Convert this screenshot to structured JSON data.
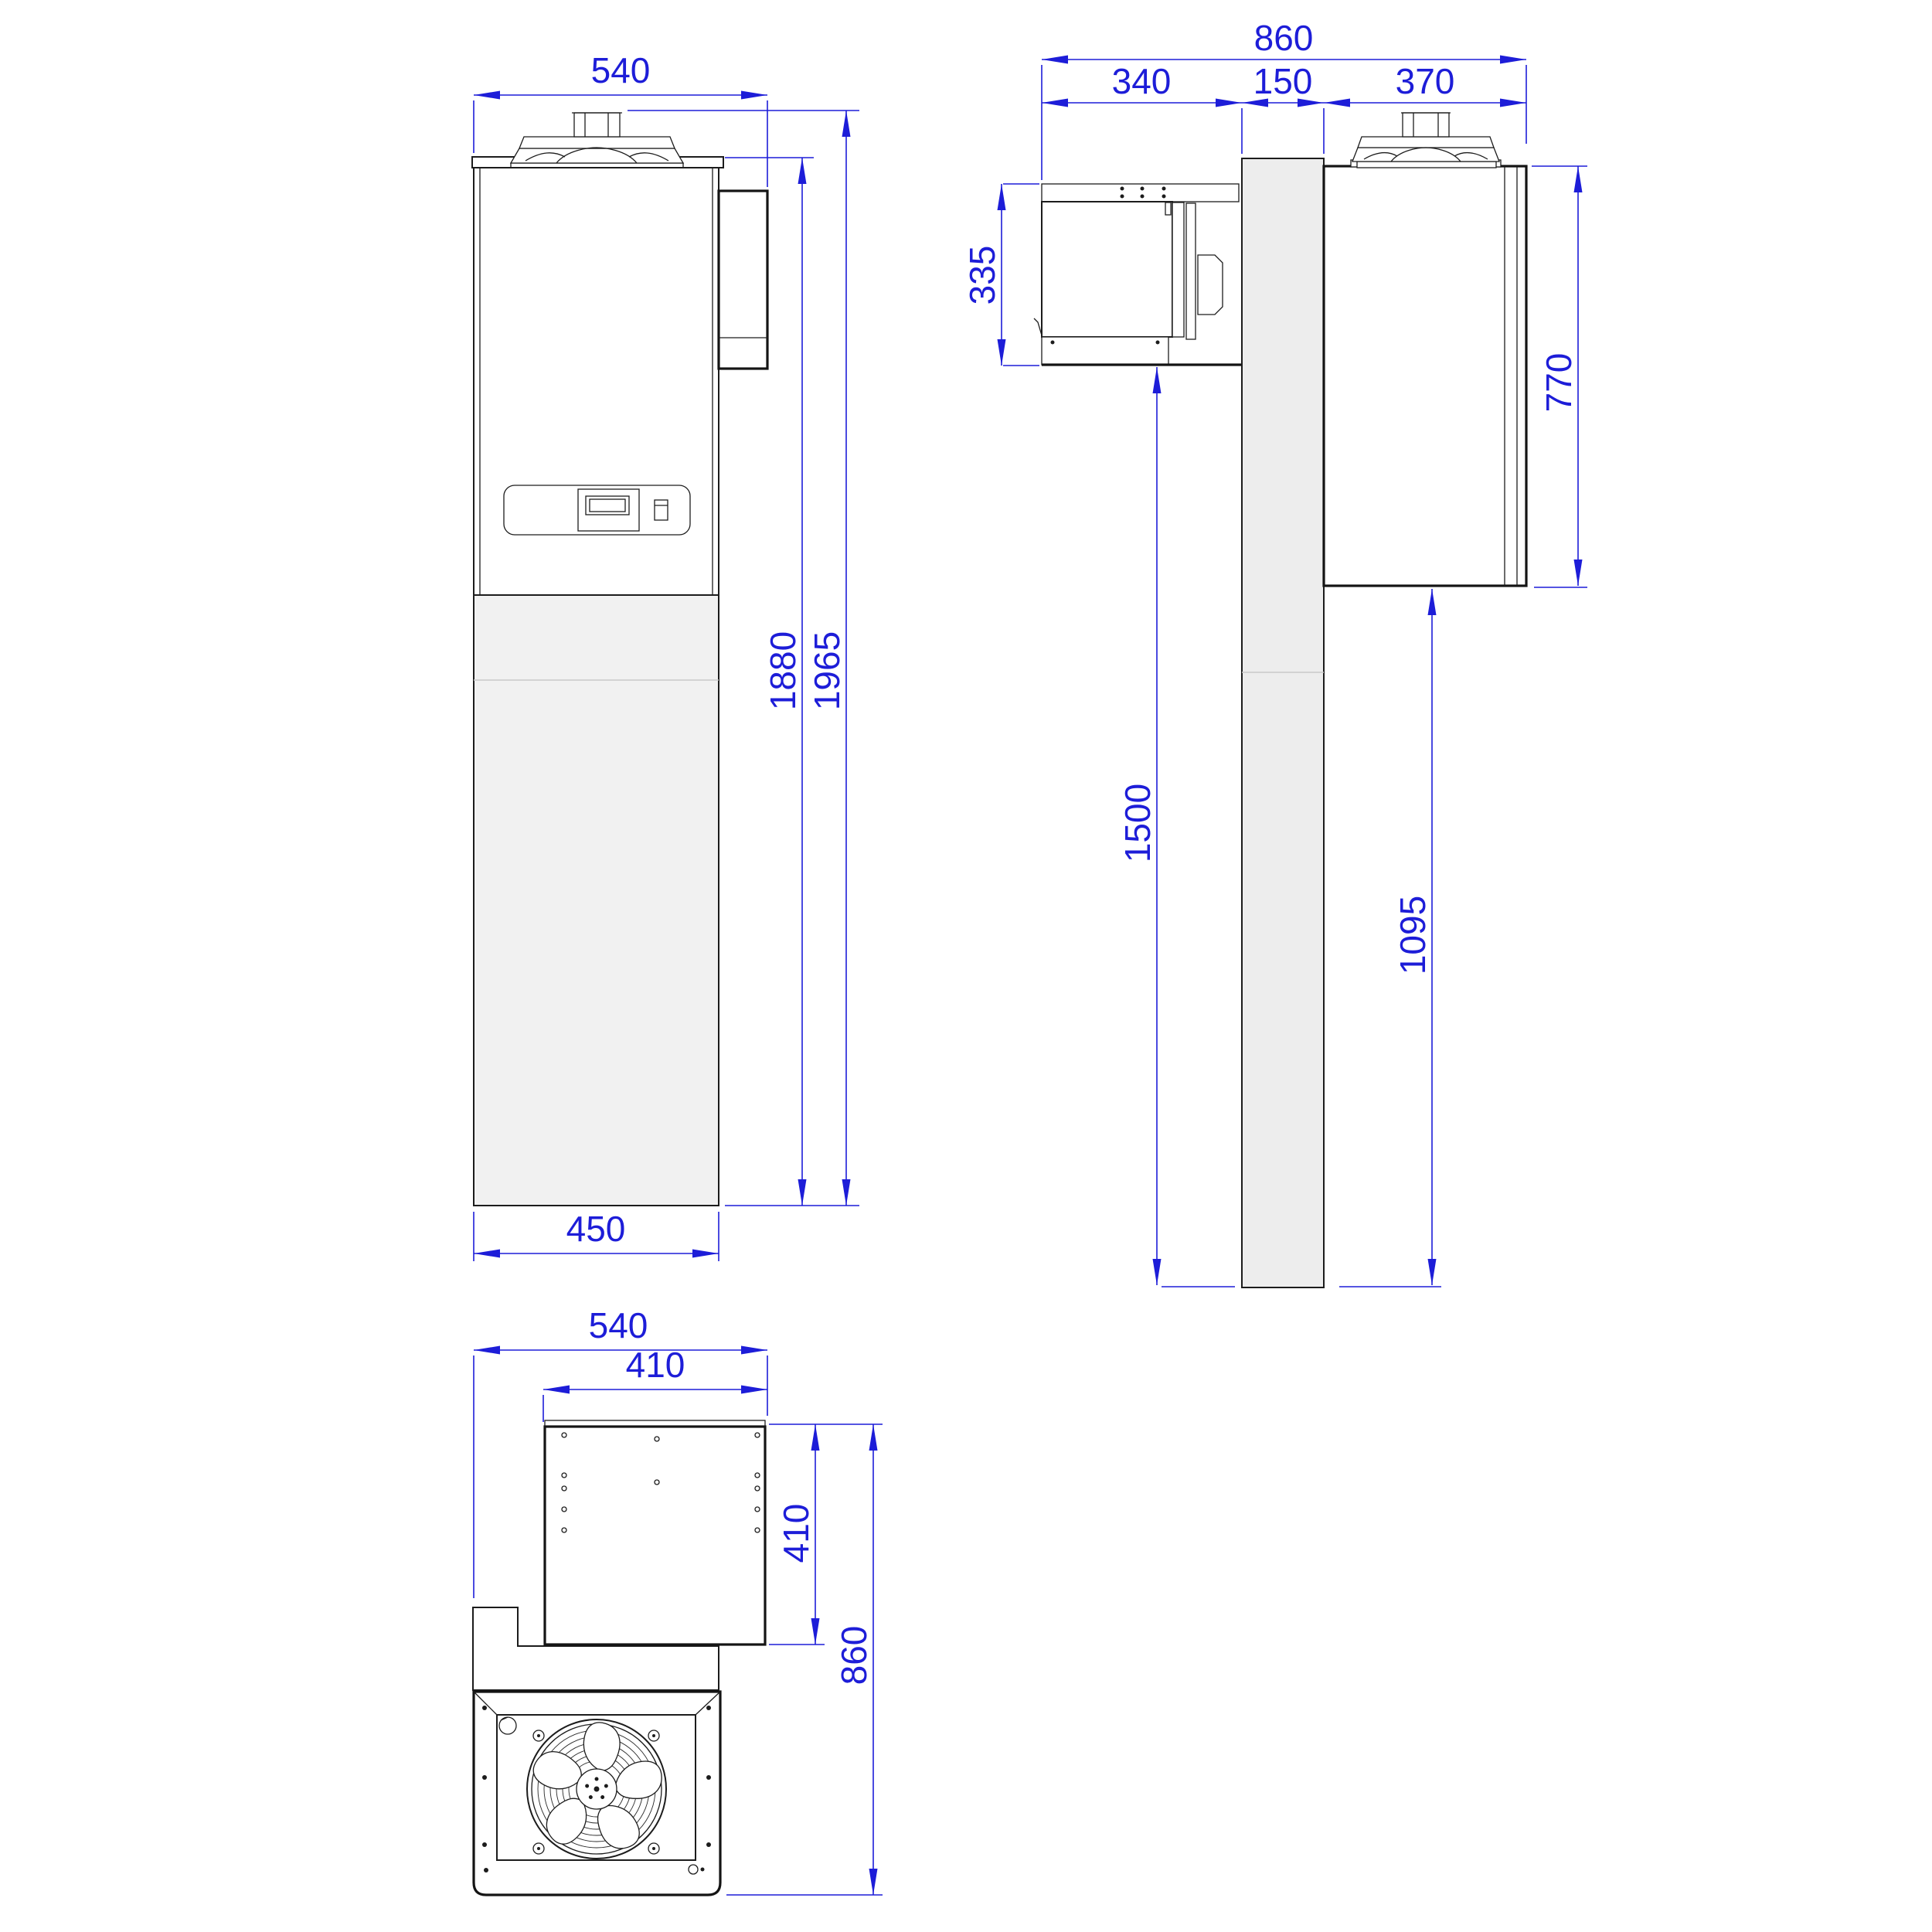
{
  "drawing": {
    "kind": "cooling-unit-dimension-drawing",
    "views": {
      "front": {
        "dims": {
          "width_total": "540",
          "base_width": "450",
          "body_height": "1880",
          "total_height": "1965"
        }
      },
      "side": {
        "dims": {
          "depth_total": "860",
          "condenser_depth": "340",
          "wall_thickness": "150",
          "evaporator_depth": "370",
          "condenser_height": "335",
          "evaporator_height": "770",
          "mount_clearance": "1500",
          "evaporator_clearance": "1095"
        }
      },
      "top": {
        "dims": {
          "width_total": "540",
          "plate_width": "410",
          "plate_depth": "410",
          "depth_total": "860"
        }
      }
    },
    "colors": {
      "dimension_blue": "#1d1dd8",
      "line_black": "#1c1c1c",
      "panel_gray": "#f1f1f1",
      "wall_gray": "#ededed"
    }
  }
}
